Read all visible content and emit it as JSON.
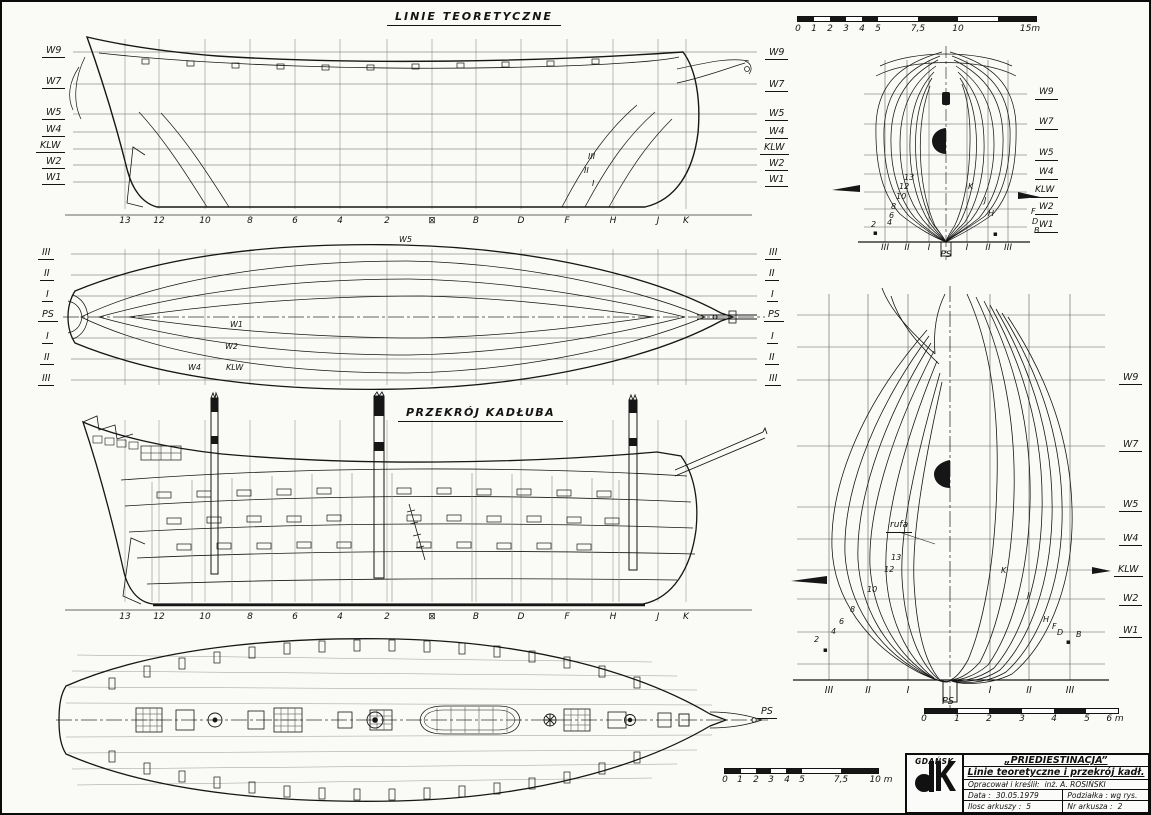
{
  "drawing": {
    "sheer_title": "LINIE TEORETYCZNE",
    "section_title": "PRZEKRÓJ KADŁUBA",
    "rufa_label": "rufa",
    "ps_label": "PS",
    "midship_mark": "▪",
    "waterlines": [
      "W9",
      "W7",
      "W5",
      "W4",
      "KLW",
      "W2",
      "W1"
    ],
    "frames": [
      "III",
      "II",
      "I",
      "PS",
      "I",
      "II",
      "III"
    ],
    "stations": [
      "13",
      "12",
      "10",
      "8",
      "6",
      "4",
      "2",
      "⊠",
      "B",
      "D",
      "F",
      "H",
      "J",
      "K"
    ],
    "buttocks": [
      "III",
      "II",
      "I"
    ],
    "halfbreadth_waterlines": [
      "W5",
      "W1",
      "W2",
      "W4",
      "KLW"
    ],
    "section_numbers": [
      "13",
      "12",
      "10",
      "8",
      "6",
      "4",
      "2"
    ],
    "section_letters": [
      "K",
      "J",
      "H",
      "F",
      "D",
      "B"
    ]
  },
  "scales": {
    "top": [
      "0",
      "1",
      "2",
      "3",
      "4",
      "5",
      "7,5",
      "10",
      "15m"
    ],
    "middle": [
      "0",
      "1",
      "2",
      "3",
      "4",
      "5",
      "7,5",
      "10 m"
    ],
    "body": [
      "0",
      "1",
      "2",
      "3",
      "4",
      "5",
      "6 m"
    ]
  },
  "titleblock": {
    "city": "GDAŃSK",
    "ship_name": "„PRIEDIESTINACJA”",
    "drawing_title": "Linie teoretyczne i przekrój kadł.",
    "author_label": "Opracował i kreślił:",
    "author_value": "inż. A. ROSIŃSKI",
    "date_label": "Data :",
    "date_value": "30.05.1979",
    "scale_label": "Podziałka : wg rys.",
    "sheets_label": "Ilosc arkuszy :",
    "sheets_value": "5",
    "sheet_no_label": "Nr arkusza :",
    "sheet_no_value": "2"
  }
}
